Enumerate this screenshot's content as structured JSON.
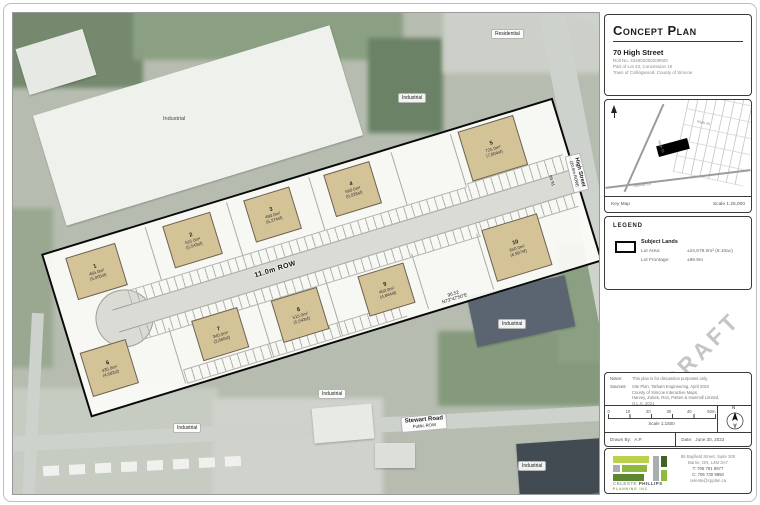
{
  "title_block": {
    "title": "Concept Plan",
    "address": "70 High Street",
    "roll": "Roll No. 434502000209500",
    "lot": "Part of Lot 43, Concession 10",
    "municipality": "Town of Collingwood, County of Simcoe"
  },
  "key_map": {
    "label": "Key Map",
    "scale": "Scale 1:25,000",
    "high_st": "High St",
    "ruth_st": "Ruth St",
    "stewart_dr": "Stewart Dr"
  },
  "legend": {
    "header": "LEGEND",
    "subject_lands": "Subject Lands",
    "lot_area_label": "Lot Area:",
    "lot_area_value": "±24,678.0m² (6.10ac)",
    "lot_frontage_label": "Lot Frontage:",
    "lot_frontage_value": "±89.9m"
  },
  "draft_text": "DRAFT",
  "notes": {
    "notes_label": "Notes:",
    "notes_text": "This plan is for discussion purposes only.",
    "sources_label": "Sources:",
    "source1": "Site Plan, Tatham Engineering, April 2022",
    "source2": "County of Simcoe Interactive Maps,",
    "source3": "Harvey, Zubek, Ron, Patten & Hammill Limited,",
    "source4": "O.L.S. 2021"
  },
  "scale_bar": {
    "t0": "0",
    "t1": "10",
    "t2": "20",
    "t3": "30",
    "t4": "40",
    "t5": "50m",
    "scale": "Scale 1:1500",
    "north": "N"
  },
  "drawn_row": {
    "drawn_by_label": "Drawn By:",
    "drawn_by": "A.P.",
    "date_label": "Date:",
    "date": "June 30, 2022"
  },
  "logo": {
    "name_a": "CELESTE",
    "name_b": "PHILLIPS",
    "tagline": "PLANNING INC",
    "addr1": "85 Bayfield Street, Suite 300",
    "addr2": "Barrie, ON, L4M 3A7",
    "addr3": "T: 705 791 8977",
    "addr4": "C: 705 730 9850",
    "addr5": "celeste@cpplan.ca"
  },
  "plan": {
    "row_label": "11.0m ROW",
    "bearing_dist": "96.52",
    "bearing": "N73°47'50\"E",
    "dim_right": "99.91",
    "buildings": [
      {
        "num": "1",
        "m2": "465.0m²",
        "sf": "(5,005sf)"
      },
      {
        "num": "2",
        "m2": "515.0m²",
        "sf": "(5,543sf)"
      },
      {
        "num": "3",
        "m2": "490.0m²",
        "sf": "(5,274sf)"
      },
      {
        "num": "4",
        "m2": "560.0m²",
        "sf": "(6,028sf)"
      },
      {
        "num": "5",
        "m2": "725.0m²",
        "sf": "(7,804sf)"
      },
      {
        "num": "6",
        "m2": "435.0m²",
        "sf": "(4,682sf)"
      },
      {
        "num": "7",
        "m2": "340.0m²",
        "sf": "(3,660sf)"
      },
      {
        "num": "8",
        "m2": "515.0m²",
        "sf": "(5,543sf)"
      },
      {
        "num": "9",
        "m2": "450.0m²",
        "sf": "(4,844sf)"
      },
      {
        "num": "10",
        "m2": "650.0m²",
        "sf": "(6,997sf)"
      }
    ]
  },
  "map_labels": {
    "industrial": "Industrial",
    "residential": "Residential",
    "high_street": "High Street",
    "high_row": "(20.0m ROW)",
    "stewart_road": "Stewart Road",
    "stewart_sub": "Public ROW"
  }
}
